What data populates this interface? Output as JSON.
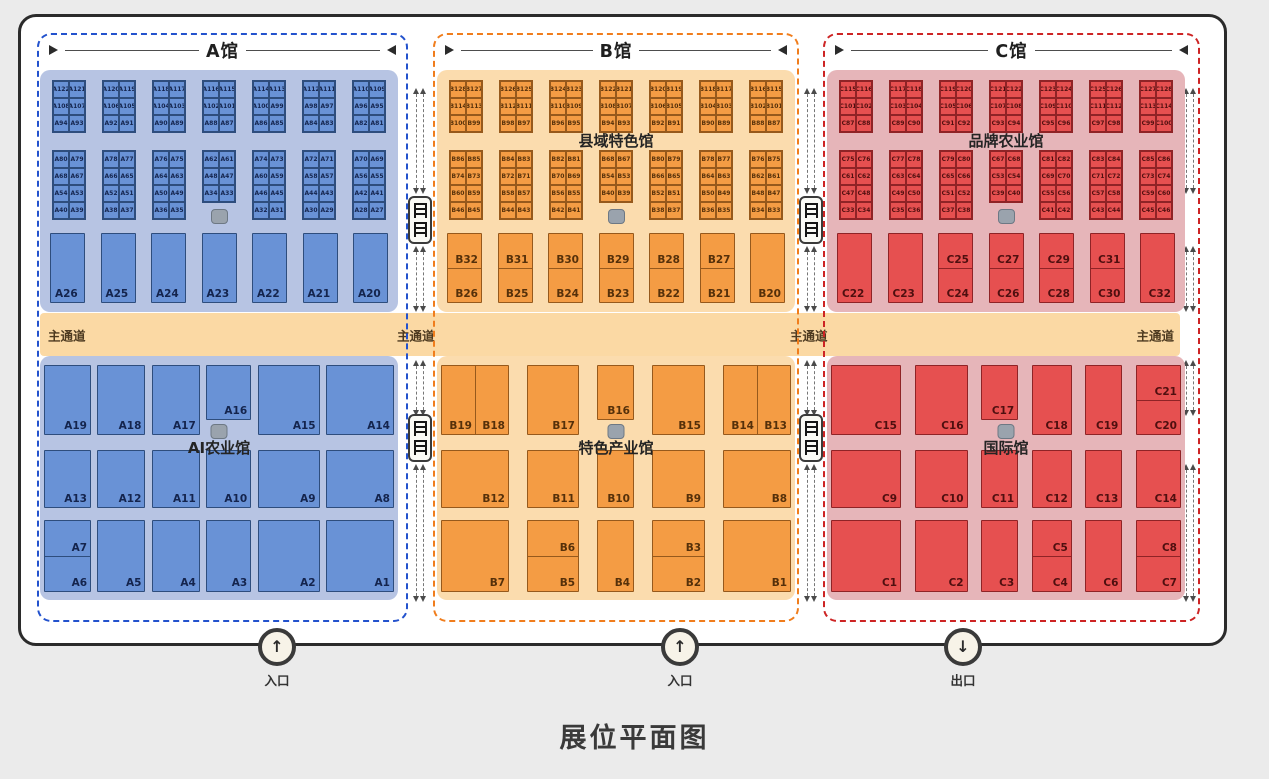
{
  "title": "展位平面图",
  "aisle": {
    "label": "主通道"
  },
  "entrances": [
    {
      "label": "入口",
      "arrow": "↑",
      "x": 277
    },
    {
      "label": "入口",
      "arrow": "↑",
      "x": 680
    },
    {
      "label": "出口",
      "arrow": "↓",
      "x": 963
    }
  ],
  "palette": {
    "page_bg": "#ebebeb",
    "panel_bg": "#ffffff",
    "panel_border": "#2b2b2b",
    "aisle_bg": "#fbd9a4",
    "facility_icon": "#9aa3ad",
    "stairs_icon_bg": "#fafaf5"
  },
  "halls": [
    {
      "id": "A",
      "title": "A馆",
      "frame_left": 37,
      "frame_width": 371,
      "area_left": 40,
      "colors": {
        "dash": "#2352cd",
        "area": "#b7c4e3",
        "booth": "#6992d6",
        "bd": "#2e4d7d",
        "text": "#14244d"
      },
      "top_label": "",
      "bottom_label": "AI农业馆",
      "bottom_cols": "47px 48px 48px 45px 62px 68px",
      "top_blocks": [
        [
          [
            "A122",
            "A121"
          ],
          [
            "A108",
            "A107"
          ],
          [
            "A94",
            "A93"
          ]
        ],
        [
          [
            "A120",
            "A119"
          ],
          [
            "A106",
            "A105"
          ],
          [
            "A92",
            "A91"
          ]
        ],
        [
          [
            "A118",
            "A117"
          ],
          [
            "A104",
            "A103"
          ],
          [
            "A90",
            "A89"
          ]
        ],
        [
          [
            "A116",
            "A115"
          ],
          [
            "A102",
            "A101"
          ],
          [
            "A88",
            "A87"
          ]
        ],
        [
          [
            "A114",
            "A113"
          ],
          [
            "A100",
            "A99"
          ],
          [
            "A86",
            "A85"
          ]
        ],
        [
          [
            "A112",
            "A111"
          ],
          [
            "A98",
            "A97"
          ],
          [
            "A84",
            "A83"
          ]
        ],
        [
          [
            "A110",
            "A109"
          ],
          [
            "A96",
            "A95"
          ],
          [
            "A82",
            "A81"
          ]
        ]
      ],
      "mid_blocks": [
        {
          "rows": [
            [
              "A80",
              "A79"
            ],
            [
              "A68",
              "A67"
            ],
            [
              "A54",
              "A53"
            ],
            [
              "A40",
              "A39"
            ]
          ]
        },
        {
          "rows": [
            [
              "A78",
              "A77"
            ],
            [
              "A66",
              "A65"
            ],
            [
              "A52",
              "A51"
            ],
            [
              "A38",
              "A37"
            ]
          ]
        },
        {
          "rows": [
            [
              "A76",
              "A75"
            ],
            [
              "A64",
              "A63"
            ],
            [
              "A50",
              "A49"
            ],
            [
              "A36",
              "A35"
            ]
          ]
        },
        {
          "rows": [
            [
              "A62",
              "A61"
            ],
            [
              "A48",
              "A47"
            ],
            [
              "A34",
              "A33"
            ]
          ],
          "short": true
        },
        {
          "rows": [
            [
              "A74",
              "A73"
            ],
            [
              "A60",
              "A59"
            ],
            [
              "A46",
              "A45"
            ],
            [
              "A32",
              "A31"
            ]
          ]
        },
        {
          "rows": [
            [
              "A72",
              "A71"
            ],
            [
              "A58",
              "A57"
            ],
            [
              "A44",
              "A43"
            ],
            [
              "A30",
              "A29"
            ]
          ]
        },
        {
          "rows": [
            [
              "A70",
              "A69"
            ],
            [
              "A56",
              "A55"
            ],
            [
              "A42",
              "A41"
            ],
            [
              "A28",
              "A27"
            ]
          ]
        }
      ],
      "row3": [
        {
          "label": "A26",
          "align": "bl"
        },
        {
          "label": "A25",
          "align": "bl"
        },
        {
          "label": "A24",
          "align": "bl"
        },
        {
          "label": "A23",
          "align": "bl"
        },
        {
          "label": "A22",
          "align": "bl"
        },
        {
          "label": "A21",
          "align": "bl"
        },
        {
          "label": "A20",
          "align": "bl"
        }
      ],
      "bottom_row1": [
        "A19",
        "A18",
        "A17",
        {
          "label": "A16",
          "short": true
        },
        "A15",
        "A14"
      ],
      "bottom_row2": [
        "A13",
        "A12",
        "A11",
        "A10",
        "A9",
        "A8"
      ],
      "bottom_row3": [
        {
          "split": [
            "A7",
            "A6"
          ]
        },
        "A5",
        "A4",
        "A3",
        "A2",
        "A1"
      ]
    },
    {
      "id": "B",
      "title": "B馆",
      "frame_left": 433,
      "frame_width": 366,
      "area_left": 437,
      "colors": {
        "dash": "#f07d1c",
        "area": "#fbdcae",
        "booth": "#f49c44",
        "bd": "#96591c",
        "text": "#55300a"
      },
      "top_label": "县域特色馆",
      "bottom_label": "特色产业馆",
      "bottom_cols": "68px 52px 37px 53px 68px",
      "top_blocks": [
        [
          [
            "B128",
            "B127"
          ],
          [
            "B114",
            "B113"
          ],
          [
            "B100",
            "B99"
          ]
        ],
        [
          [
            "B126",
            "B125"
          ],
          [
            "B112",
            "B111"
          ],
          [
            "B98",
            "B97"
          ]
        ],
        [
          [
            "B124",
            "B123"
          ],
          [
            "B110",
            "B109"
          ],
          [
            "B96",
            "B95"
          ]
        ],
        [
          [
            "B122",
            "B121"
          ],
          [
            "B108",
            "B107"
          ],
          [
            "B94",
            "B93"
          ]
        ],
        [
          [
            "B120",
            "B119"
          ],
          [
            "B106",
            "B105"
          ],
          [
            "B92",
            "B91"
          ]
        ],
        [
          [
            "B118",
            "B117"
          ],
          [
            "B104",
            "B103"
          ],
          [
            "B90",
            "B89"
          ]
        ],
        [
          [
            "B116",
            "B115"
          ],
          [
            "B102",
            "B101"
          ],
          [
            "B88",
            "B87"
          ]
        ]
      ],
      "mid_blocks": [
        {
          "rows": [
            [
              "B86",
              "B85"
            ],
            [
              "B74",
              "B73"
            ],
            [
              "B60",
              "B59"
            ],
            [
              "B46",
              "B45"
            ]
          ]
        },
        {
          "rows": [
            [
              "B84",
              "B83"
            ],
            [
              "B72",
              "B71"
            ],
            [
              "B58",
              "B57"
            ],
            [
              "B44",
              "B43"
            ]
          ]
        },
        {
          "rows": [
            [
              "B82",
              "B81"
            ],
            [
              "B70",
              "B69"
            ],
            [
              "B56",
              "B55"
            ],
            [
              "B42",
              "B41"
            ]
          ]
        },
        {
          "rows": [
            [
              "B68",
              "B67"
            ],
            [
              "B54",
              "B53"
            ],
            [
              "B40",
              "B39"
            ]
          ],
          "short": true
        },
        {
          "rows": [
            [
              "B80",
              "B79"
            ],
            [
              "B66",
              "B65"
            ],
            [
              "B52",
              "B51"
            ],
            [
              "B38",
              "B37"
            ]
          ]
        },
        {
          "rows": [
            [
              "B78",
              "B77"
            ],
            [
              "B64",
              "B63"
            ],
            [
              "B50",
              "B49"
            ],
            [
              "B36",
              "B35"
            ]
          ]
        },
        {
          "rows": [
            [
              "B76",
              "B75"
            ],
            [
              "B62",
              "B61"
            ],
            [
              "B48",
              "B47"
            ],
            [
              "B34",
              "B33"
            ]
          ]
        }
      ],
      "row3": [
        {
          "split": [
            "B32",
            "B26"
          ]
        },
        {
          "split": [
            "B31",
            "B25"
          ]
        },
        {
          "split": [
            "B30",
            "B24"
          ]
        },
        {
          "split": [
            "B29",
            "B23"
          ]
        },
        {
          "split": [
            "B28",
            "B22"
          ]
        },
        {
          "split": [
            "B27",
            "B21"
          ]
        },
        {
          "label": "B20"
        }
      ],
      "bottom_row1": [
        {
          "pair": [
            "B19",
            "B18"
          ]
        },
        "B17",
        {
          "label": "B16",
          "short": true
        },
        "B15",
        {
          "pair": [
            "B14",
            "B13"
          ]
        }
      ],
      "bottom_row2": [
        "B12",
        "B11",
        "B10",
        "B9",
        "B8"
      ],
      "bottom_row3": [
        "B7",
        {
          "split": [
            "B6",
            "B5"
          ]
        },
        "B4",
        {
          "split": [
            "B3",
            "B2"
          ]
        },
        "B1"
      ]
    },
    {
      "id": "C",
      "title": "C馆",
      "frame_left": 823,
      "frame_width": 377,
      "area_left": 827,
      "colors": {
        "dash": "#cd2424",
        "area": "#e6b5b9",
        "booth": "#e65050",
        "bd": "#8f2326",
        "text": "#4f0f0f"
      },
      "top_label": "品牌农业馆",
      "bottom_label": "国际馆",
      "bottom_cols": "70px 53px 37px 40px 37px 45px",
      "top_blocks": [
        [
          [
            "C115",
            "C116"
          ],
          [
            "C101",
            "C102"
          ],
          [
            "C87",
            "C88"
          ]
        ],
        [
          [
            "C117",
            "C118"
          ],
          [
            "C103",
            "C104"
          ],
          [
            "C89",
            "C90"
          ]
        ],
        [
          [
            "C119",
            "C120"
          ],
          [
            "C105",
            "C106"
          ],
          [
            "C91",
            "C92"
          ]
        ],
        [
          [
            "C121",
            "C122"
          ],
          [
            "C107",
            "C108"
          ],
          [
            "C93",
            "C94"
          ]
        ],
        [
          [
            "C123",
            "C124"
          ],
          [
            "C109",
            "C110"
          ],
          [
            "C95",
            "C96"
          ]
        ],
        [
          [
            "C125",
            "C126"
          ],
          [
            "C111",
            "C112"
          ],
          [
            "C97",
            "C98"
          ]
        ],
        [
          [
            "C127",
            "C128"
          ],
          [
            "C113",
            "C114"
          ],
          [
            "C99",
            "C100"
          ]
        ]
      ],
      "mid_blocks": [
        {
          "rows": [
            [
              "C75",
              "C76"
            ],
            [
              "C61",
              "C62"
            ],
            [
              "C47",
              "C48"
            ],
            [
              "C33",
              "C34"
            ]
          ]
        },
        {
          "rows": [
            [
              "C77",
              "C78"
            ],
            [
              "C63",
              "C64"
            ],
            [
              "C49",
              "C50"
            ],
            [
              "C35",
              "C36"
            ]
          ]
        },
        {
          "rows": [
            [
              "C79",
              "C80"
            ],
            [
              "C65",
              "C66"
            ],
            [
              "C51",
              "C52"
            ],
            [
              "C37",
              "C38"
            ]
          ]
        },
        {
          "rows": [
            [
              "C67",
              "C68"
            ],
            [
              "C53",
              "C54"
            ],
            [
              "C39",
              "C40"
            ]
          ],
          "short": true
        },
        {
          "rows": [
            [
              "C81",
              "C82"
            ],
            [
              "C69",
              "C70"
            ],
            [
              "C55",
              "C56"
            ],
            [
              "C41",
              "C42"
            ]
          ]
        },
        {
          "rows": [
            [
              "C83",
              "C84"
            ],
            [
              "C71",
              "C72"
            ],
            [
              "C57",
              "C58"
            ],
            [
              "C43",
              "C44"
            ]
          ]
        },
        {
          "rows": [
            [
              "C85",
              "C86"
            ],
            [
              "C73",
              "C74"
            ],
            [
              "C59",
              "C60"
            ],
            [
              "C45",
              "C46"
            ]
          ]
        }
      ],
      "row3": [
        {
          "label": "C22",
          "align": "bl"
        },
        {
          "label": "C23",
          "align": "bl"
        },
        {
          "split": [
            "C25",
            "C24"
          ]
        },
        {
          "split": [
            "C27",
            "C26"
          ]
        },
        {
          "split": [
            "C29",
            "C28"
          ]
        },
        {
          "split": [
            "C31",
            "C30"
          ]
        },
        {
          "label": "C32"
        }
      ],
      "bottom_row1": [
        "C15",
        "C16",
        {
          "label": "C17",
          "short": true
        },
        "C18",
        "C19",
        {
          "split": [
            "C21",
            "C20"
          ]
        }
      ],
      "bottom_row2": [
        "C9",
        "C10",
        "C11",
        "C12",
        "C13",
        "C14"
      ],
      "bottom_row3": [
        "C1",
        "C2",
        "C3",
        {
          "split": [
            "C5",
            "C4"
          ]
        },
        "C6",
        {
          "split": [
            "C8",
            "C7"
          ]
        }
      ]
    }
  ]
}
